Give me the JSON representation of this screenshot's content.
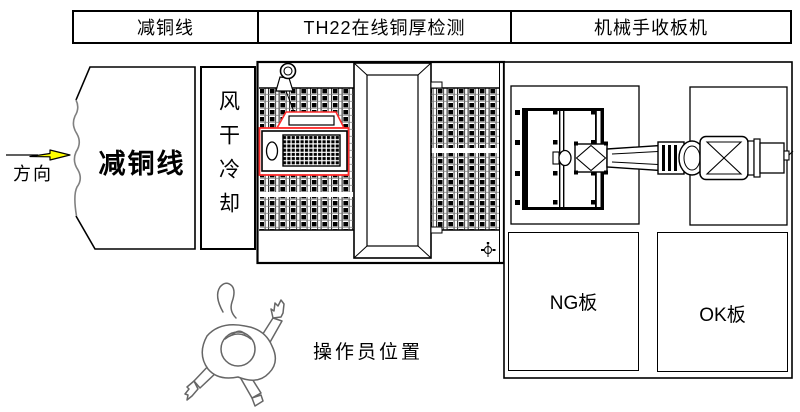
{
  "header": {
    "cells": [
      {
        "label": "减铜线"
      },
      {
        "label": "TH22在线铜厚检测"
      },
      {
        "label": "机械手收板机"
      }
    ]
  },
  "flow": {
    "direction_label": "方向",
    "copper_line_label": "减铜线",
    "cooling_label": "风干冷却"
  },
  "sorting": {
    "ng_label": "NG板",
    "ok_label": "OK板"
  },
  "operator": {
    "label": "操作员位置"
  },
  "colors": {
    "line": "#000000",
    "scanner_outline_red": "#ff2b2b",
    "direction_arrow_yellow": "#ffff00",
    "sketch_gray": "#808080"
  }
}
